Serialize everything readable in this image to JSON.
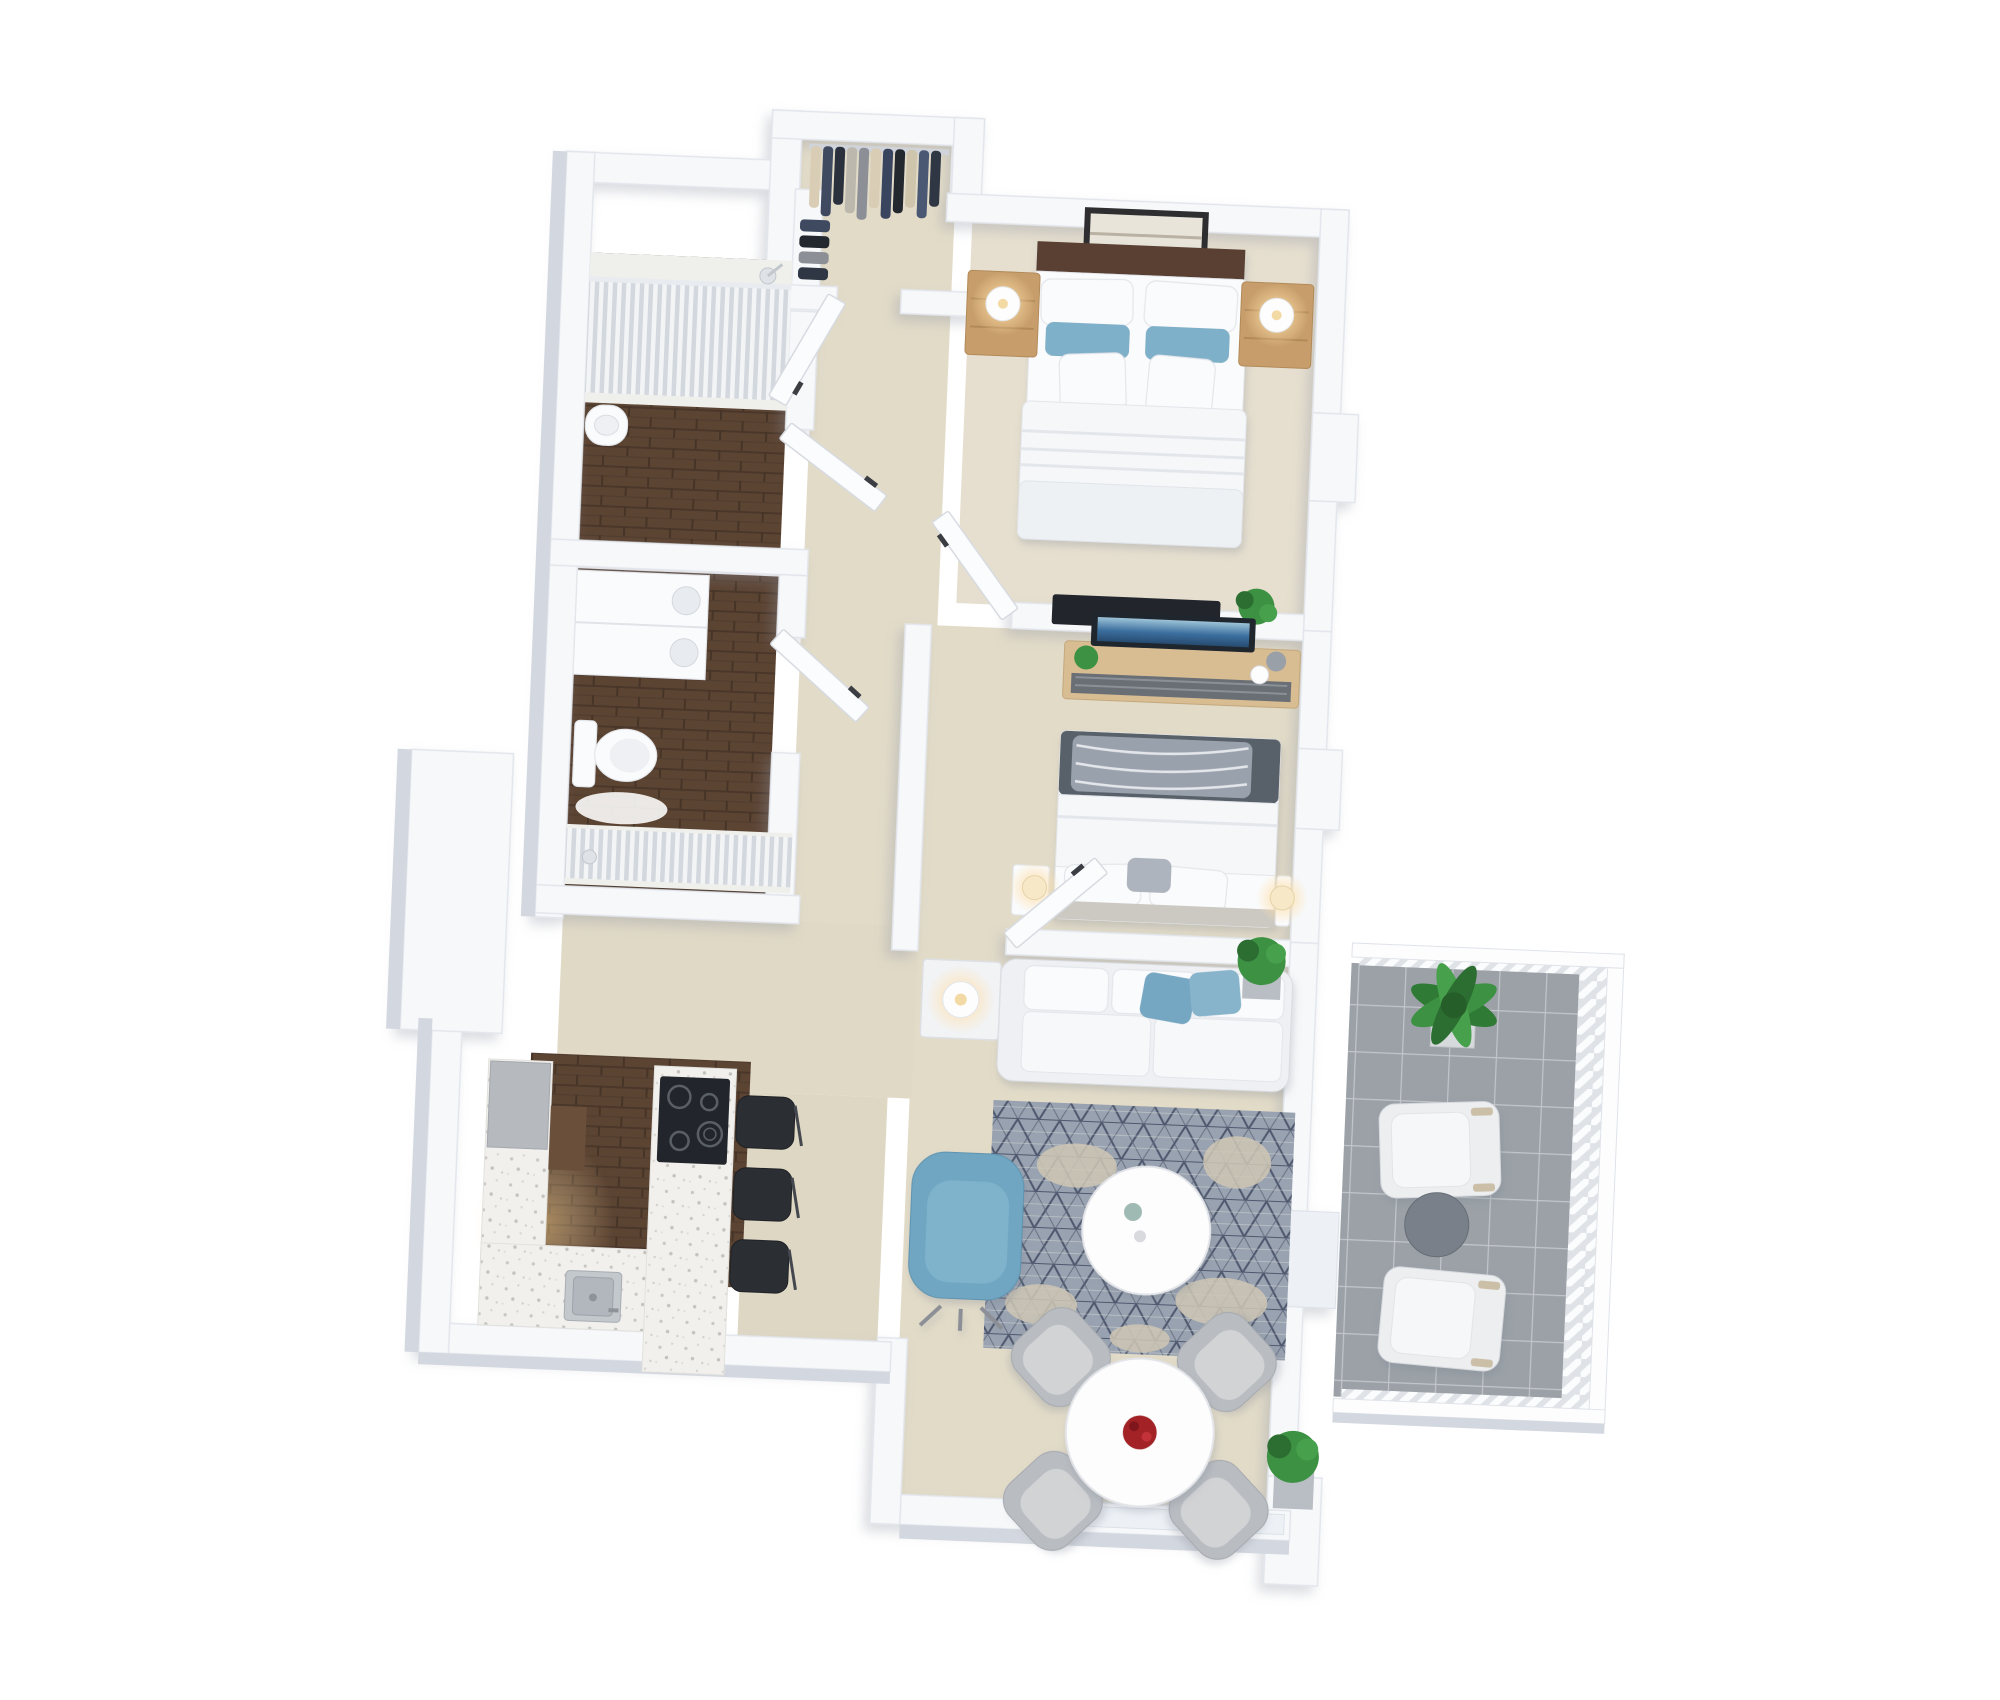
{
  "meta": {
    "title": "3D isometric floor plan render — two-bedroom apartment with balcony",
    "view": "top-down 3D dollhouse render",
    "background": "#ffffff"
  },
  "palette": {
    "background": "#ffffff",
    "wall": "#f7f8fa",
    "wall_shade": "#d3d7df",
    "floor_carpet": "#e2dbc8",
    "floor_wood": "#5c4433",
    "counter_terrazzo": "#f1f0ec",
    "balcony_tile": "#9ba1a7",
    "rug_base": "#99a2b0",
    "rug_pattern": "#4e586e",
    "rug_cream": "#cfc7b5",
    "sofa_white": "#f2f3f5",
    "accent_blue": "#6fa6c2",
    "pillow_blue": "#7fb0c9",
    "bed_white": "#fafbfc",
    "headboard_wood": "#5a4130",
    "nightstand_wood": "#c79e6b",
    "blanket_gray": "#596069",
    "tv_black": "#22262c",
    "stool_black": "#2b2e33",
    "steel_gray": "#c3c8cd",
    "chair_gray": "#b9bdc2",
    "outdoor_chair": "#eceef0",
    "outdoor_table": "#798089",
    "plant_green": "#3d9142",
    "flower_red": "#a32127",
    "lamp_glow": "#ffdfa8",
    "door_white": "#fbfcfd",
    "curtain_light": "#f2f4f6",
    "curtain_shade": "#d3d8de"
  },
  "rooms": [
    {
      "id": "master-bedroom",
      "name": "Master bedroom",
      "furniture": [
        "double bed with white duvet",
        "two white pillows",
        "two blue accent pillows",
        "dark wood headboard",
        "framed wall art",
        "left wooden nightstand with lit lamp",
        "right wooden nightstand with lit lamp",
        "wall TV",
        "potted plant"
      ]
    },
    {
      "id": "walk-in-closet",
      "name": "Walk-in closet",
      "furniture": [
        "clothes rail with hanging garments (beige, navy, charcoal, taupe)",
        "side rail with folded garments"
      ]
    },
    {
      "id": "bathroom-top",
      "name": "Bathroom 1",
      "furniture": [
        "walk-in shower with white curtain",
        "shower head",
        "pedestal basin",
        "dark wood floor"
      ]
    },
    {
      "id": "bathroom-middle",
      "name": "Bathroom 2",
      "furniture": [
        "stacked laundry / cabinet unit",
        "toilet",
        "walk-in shower with white curtain",
        "hand shower",
        "dark wood floor"
      ]
    },
    {
      "id": "second-bedroom",
      "name": "Second bedroom",
      "furniture": [
        "double bed with gray blanket and patterned throw",
        "white pillows",
        "media console with TV",
        "small plant",
        "two glowing bedside lamps",
        "white bedside shelves"
      ]
    },
    {
      "id": "living-room",
      "name": "Living room",
      "furniture": [
        "white three-seat sofa",
        "two blue cushions",
        "white side table with lit lamp",
        "blue lounge armchair",
        "round white coffee table",
        "gray geometric rug with cream patches",
        "potted plant"
      ]
    },
    {
      "id": "kitchen",
      "name": "Kitchen",
      "furniture": [
        "U-shaped terrazzo counter",
        "black four-zone cooktop",
        "stainless steel sink",
        "gray appliance column",
        "dark cabinet",
        "three black bar stools",
        "dark wood floor"
      ]
    },
    {
      "id": "dining-area",
      "name": "Dining area",
      "furniture": [
        "round white dining table",
        "red rose centerpiece",
        "four gray dining chairs",
        "potted plant",
        "wide window in bottom wall"
      ]
    },
    {
      "id": "hallway",
      "name": "Hallway",
      "furniture": [
        "five white hinged doors ajar with dark handles"
      ]
    },
    {
      "id": "balcony",
      "name": "Balcony",
      "furniture": [
        "gray tile floor",
        "white slatted railing",
        "large potted plant",
        "two white outdoor lounge chairs",
        "round gray side table"
      ]
    }
  ],
  "counts": {
    "bedrooms": 2,
    "bathrooms": 2,
    "balconies": 1,
    "bar_stools": 3,
    "dining_chairs": 4,
    "outdoor_chairs": 2,
    "interior_doors": 5
  }
}
